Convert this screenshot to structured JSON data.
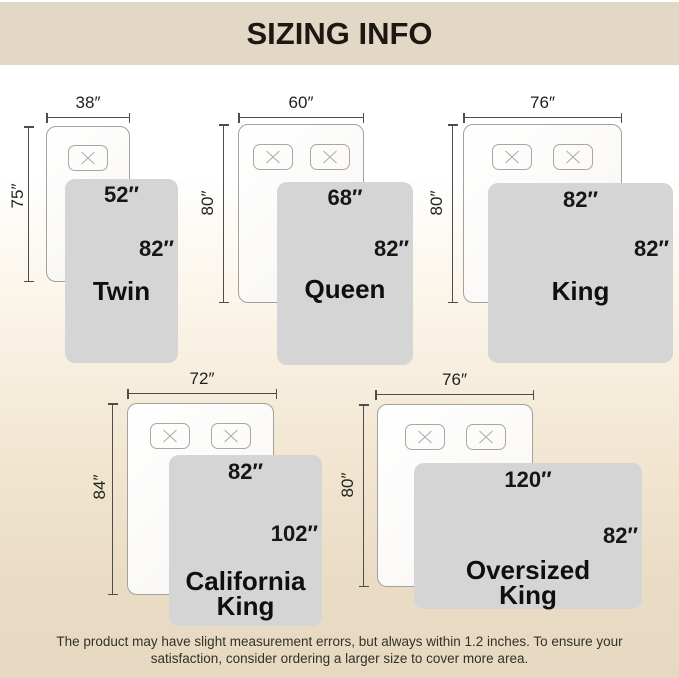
{
  "header": {
    "title": "SIZING INFO"
  },
  "sizes": [
    {
      "name": "Twin",
      "mattress_width": "38″",
      "mattress_length": "75″",
      "blanket_width": "52″",
      "blanket_length": "82″",
      "pillow_count": 1
    },
    {
      "name": "Queen",
      "mattress_width": "60″",
      "mattress_length": "80″",
      "blanket_width": "68″",
      "blanket_length": "82″",
      "pillow_count": 2
    },
    {
      "name": "King",
      "mattress_width": "76″",
      "mattress_length": "80″",
      "blanket_width": "82″",
      "blanket_length": "82″",
      "pillow_count": 2
    },
    {
      "name": "California\nKing",
      "mattress_width": "72″",
      "mattress_length": "84″",
      "blanket_width": "82″",
      "blanket_length": "102″",
      "pillow_count": 2
    },
    {
      "name": "Oversized\nKing",
      "mattress_width": "76″",
      "mattress_length": "80″",
      "blanket_width": "120″",
      "blanket_length": "82″",
      "pillow_count": 2
    }
  ],
  "footer": {
    "note": "The product may have slight measurement errors, but always within 1.2 inches. To ensure your\nsatisfaction, consider ordering a larger size to cover more area."
  },
  "colors": {
    "header_bg": "#e3d8c6",
    "title_text": "#1d1812",
    "blanket_fill": "#d5d5d6",
    "page_bottom": "#e7d9c1",
    "label_text": "#161616"
  }
}
